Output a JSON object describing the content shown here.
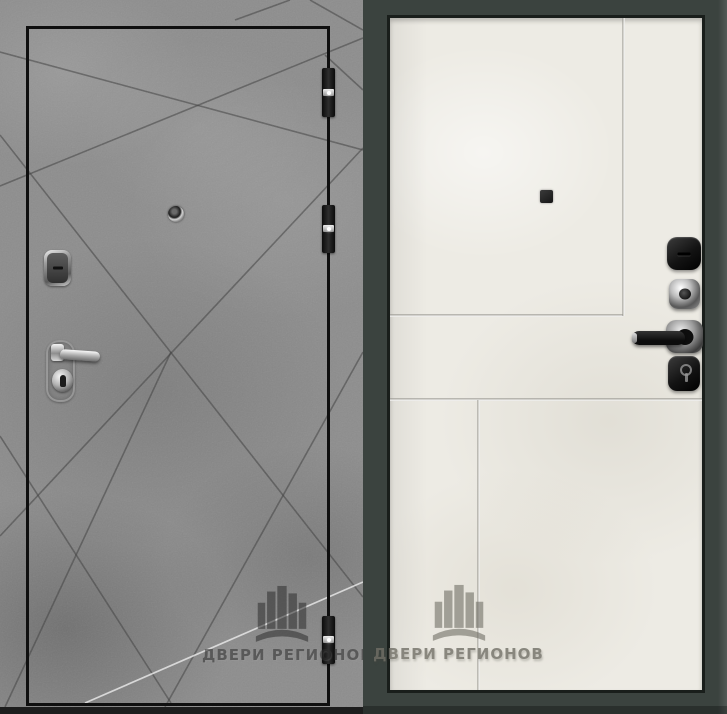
{
  "brand": {
    "watermark_text": "ДВЕРИ РЕГИОНОВ"
  },
  "photo": {
    "subject": "steel-entrance-door-two-sides",
    "left_door": {
      "side_name": "exterior-side",
      "finish": "gray-concrete-with-diagonal-grooves",
      "color_hex": "#8d8d8d",
      "hinge_count": 3,
      "hardware": [
        "peephole",
        "lock-escutcheon",
        "lever-handle",
        "keyhole"
      ]
    },
    "right_door": {
      "side_name": "interior-side",
      "finish": "white-stone-with-panel-grooves",
      "color_hex": "#edebe4",
      "frame_color_hex": "#3b433f",
      "hardware": [
        "peephole",
        "thumbturn-cover",
        "key-escutcheon",
        "lever-handle",
        "cylinder-cover"
      ]
    }
  }
}
